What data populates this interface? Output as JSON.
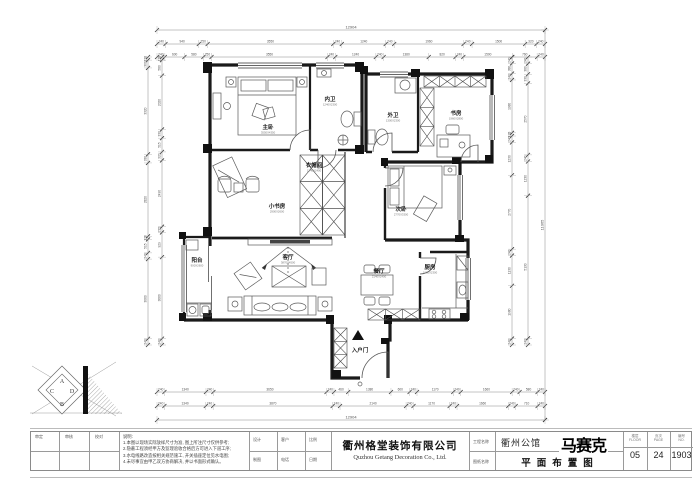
{
  "title_bar": {
    "left_cells": [
      {
        "label": "审定"
      },
      {
        "label": "审核"
      },
      {
        "label": "校对"
      }
    ],
    "notes": {
      "title": "说明:",
      "lines": [
        "1.本图以现场实际放样尺寸为准, 图上所注尺寸仅供参考;",
        "2.隐蔽工程须经甲方及监理验收合格后方可进入下道工序;",
        "3.水电线路改造按相关规范施工, 开关插座定位见水电图;",
        "4.未尽事宜由甲乙双方协商解决, 并以书面形式确认。"
      ]
    },
    "mid_cells": [
      {
        "top": "设计",
        "bottom": "制图"
      },
      {
        "top": "客户",
        "bottom": "电话"
      },
      {
        "top": "比例",
        "bottom": "日期"
      }
    ],
    "company": {
      "cn": "衢州格堂装饰有限公司",
      "en": "Quzhou Getang Decoration Co., Ltd."
    },
    "name_labels": {
      "top": "工程名称",
      "bottom": "图纸名称"
    },
    "project": {
      "name": "衢州公馆",
      "logo": "马赛克",
      "drawing": "平面布置图"
    },
    "value_boxes": [
      {
        "label": "楼层",
        "sub": "FLOOR",
        "value": "05"
      },
      {
        "label": "页次",
        "sub": "PAGE",
        "value": "24"
      },
      {
        "label": "编号",
        "sub": "NO.",
        "value": "1903"
      }
    ]
  },
  "logo": {
    "letters": [
      "A",
      "D",
      "B",
      "C"
    ]
  },
  "plan": {
    "rooms": [
      {
        "name": "主卧",
        "sub": "3550X4350",
        "x": 268,
        "y": 129
      },
      {
        "name": "内卫",
        "sub": "1240X2300",
        "x": 330,
        "y": 101
      },
      {
        "name": "外卫",
        "sub": "1300X2300",
        "x": 393,
        "y": 117
      },
      {
        "name": "书房",
        "sub": "1960X2800",
        "x": 456,
        "y": 115
      },
      {
        "name": "衣帽间",
        "sub": "1240X2400",
        "x": 314,
        "y": 167
      },
      {
        "name": "小书房",
        "sub": "2900X2600",
        "x": 277,
        "y": 208
      },
      {
        "name": "次卧",
        "sub": "2770X3300",
        "x": 401,
        "y": 211
      },
      {
        "name": "客厅",
        "sub": "3870X4500",
        "x": 288,
        "y": 259
      },
      {
        "name": "阳台",
        "sub": "900X2600",
        "x": 197,
        "y": 262
      },
      {
        "name": "餐厅",
        "sub": "2140X2400",
        "x": 379,
        "y": 273
      },
      {
        "name": "厨房",
        "sub": "1660X2300",
        "x": 430,
        "y": 269
      },
      {
        "name": "入户门",
        "sub": "",
        "x": 360,
        "y": 352
      }
    ]
  },
  "dimensions": {
    "chains": [
      {
        "o": "h",
        "y": 30,
        "x1": 157,
        "x2": 545,
        "total": true,
        "vals": [
          "12904"
        ]
      },
      {
        "o": "h",
        "y": 44,
        "x1": 157,
        "x2": 545,
        "total": false,
        "vals": [
          240,
          940,
          250,
          3550,
          240,
          1240,
          240,
          1960,
          240,
          1500,
          320,
          240
        ]
      },
      {
        "o": "h",
        "y": 57,
        "x1": 157,
        "x2": 545,
        "total": false,
        "vals": [
          240,
          600,
          580,
          250,
          3550,
          240,
          1240,
          240,
          1380,
          820,
          240,
          1500,
          760,
          240
        ]
      },
      {
        "o": "h",
        "y": 392,
        "x1": 157,
        "x2": 545,
        "total": false,
        "vals": [
          240,
          1340,
          240,
          3650,
          240,
          460,
          1380,
          600,
          240,
          1170,
          240,
          1660,
          240,
          580,
          240
        ]
      },
      {
        "o": "h",
        "y": 406,
        "x1": 157,
        "x2": 545,
        "total": false,
        "vals": [
          240,
          1340,
          240,
          3870,
          240,
          2140,
          240,
          1170,
          240,
          1660,
          240,
          710,
          240
        ]
      },
      {
        "o": "h",
        "y": 420,
        "x1": 157,
        "x2": 545,
        "total": true,
        "vals": [
          "12904"
        ]
      },
      {
        "o": "v",
        "x": 148,
        "y1": 57,
        "y2": 345,
        "total": false,
        "vals": [
          120,
          300,
          3320,
          330,
          2820,
          120,
          515,
          240,
          3060,
          240
        ]
      },
      {
        "o": "v",
        "x": 162,
        "y1": 57,
        "y2": 345,
        "total": false,
        "vals": [
          120,
          580,
          2020,
          330,
          515,
          320,
          2490,
          215,
          929,
          3060,
          240
        ]
      },
      {
        "o": "v",
        "x": 512,
        "y1": 57,
        "y2": 345,
        "total": false,
        "vals": [
          240,
          380,
          240,
          1980,
          120,
          240,
          1230,
          2770,
          240,
          1130,
          1980,
          240
        ]
      },
      {
        "o": "v",
        "x": 528,
        "y1": 57,
        "y2": 345,
        "total": false,
        "vals": [
          240,
          380,
          330,
          2570,
          240,
          1230,
          5130,
          240
        ]
      },
      {
        "o": "v",
        "x": 545,
        "y1": 30,
        "y2": 420,
        "total": true,
        "vals": [
          "11065"
        ]
      }
    ]
  }
}
